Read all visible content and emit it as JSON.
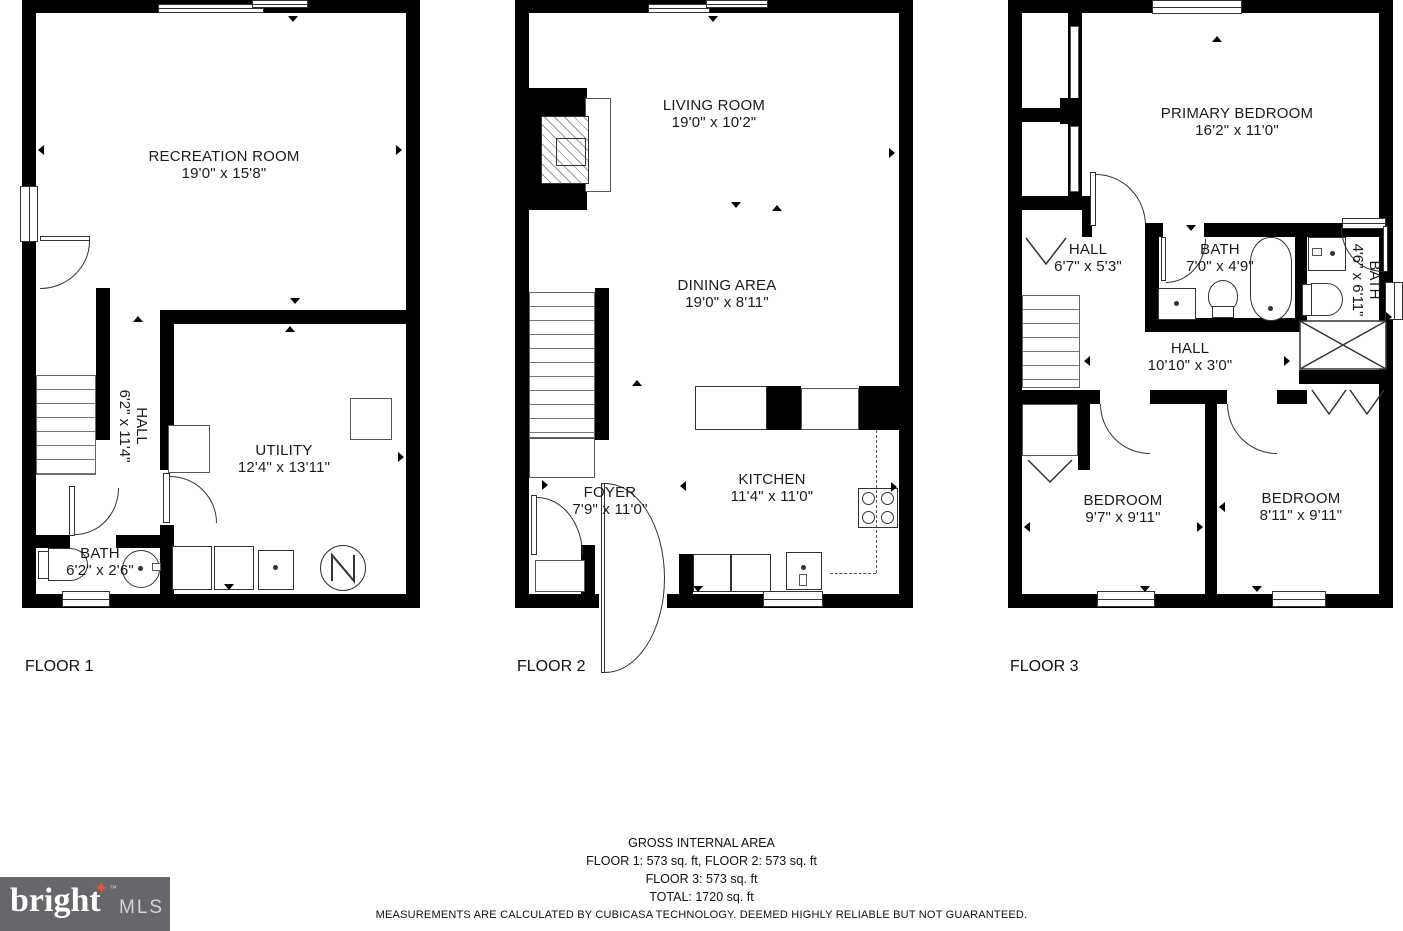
{
  "floors": [
    {
      "label": "FLOOR 1",
      "rooms": [
        {
          "name": "RECREATION ROOM",
          "dims": "19'0\" x 15'8\""
        },
        {
          "name": "HALL",
          "dims": "6'2\" x 11'4\""
        },
        {
          "name": "UTILITY",
          "dims": "12'4\" x 13'11\""
        },
        {
          "name": "BATH",
          "dims": "6'2\" x 2'6\""
        }
      ]
    },
    {
      "label": "FLOOR 2",
      "rooms": [
        {
          "name": "LIVING ROOM",
          "dims": "19'0\" x 10'2\""
        },
        {
          "name": "DINING AREA",
          "dims": "19'0\" x 8'11\""
        },
        {
          "name": "FOYER",
          "dims": "7'9\" x 11'0\""
        },
        {
          "name": "KITCHEN",
          "dims": "11'4\" x 11'0\""
        }
      ]
    },
    {
      "label": "FLOOR 3",
      "rooms": [
        {
          "name": "PRIMARY BEDROOM",
          "dims": "16'2\" x 11'0\""
        },
        {
          "name": "HALL",
          "dims": "6'7\" x 5'3\""
        },
        {
          "name": "BATH",
          "dims": "7'0\" x 4'9\""
        },
        {
          "name": "BATH",
          "dims": "4'6\" x 6'11\""
        },
        {
          "name": "HALL",
          "dims": "10'10\" x 3'0\""
        },
        {
          "name": "BEDROOM",
          "dims": "9'7\" x 9'11\""
        },
        {
          "name": "BEDROOM",
          "dims": "8'11\" x 9'11\""
        }
      ]
    }
  ],
  "footer": {
    "heading": "GROSS INTERNAL AREA",
    "area_line_1": "FLOOR 1: 573 sq. ft, FLOOR 2: 573 sq. ft",
    "area_line_2": "FLOOR 3: 573 sq. ft",
    "total_line": "TOTAL: 1720 sq. ft",
    "disclaimer": "MEASUREMENTS ARE CALCULATED BY CUBICASA TECHNOLOGY. DEEMED HIGHLY RELIABLE BUT NOT GUARANTEED."
  },
  "logo": {
    "brand": "bright",
    "tm": "™",
    "suffix": "MLS",
    "star_icon": "✦"
  },
  "colors": {
    "wall": "#000000",
    "text": "#1b1b1b",
    "logo_bg": "#67676b",
    "logo_star": "#e4572e",
    "logo_mls": "#d4d4d4"
  }
}
